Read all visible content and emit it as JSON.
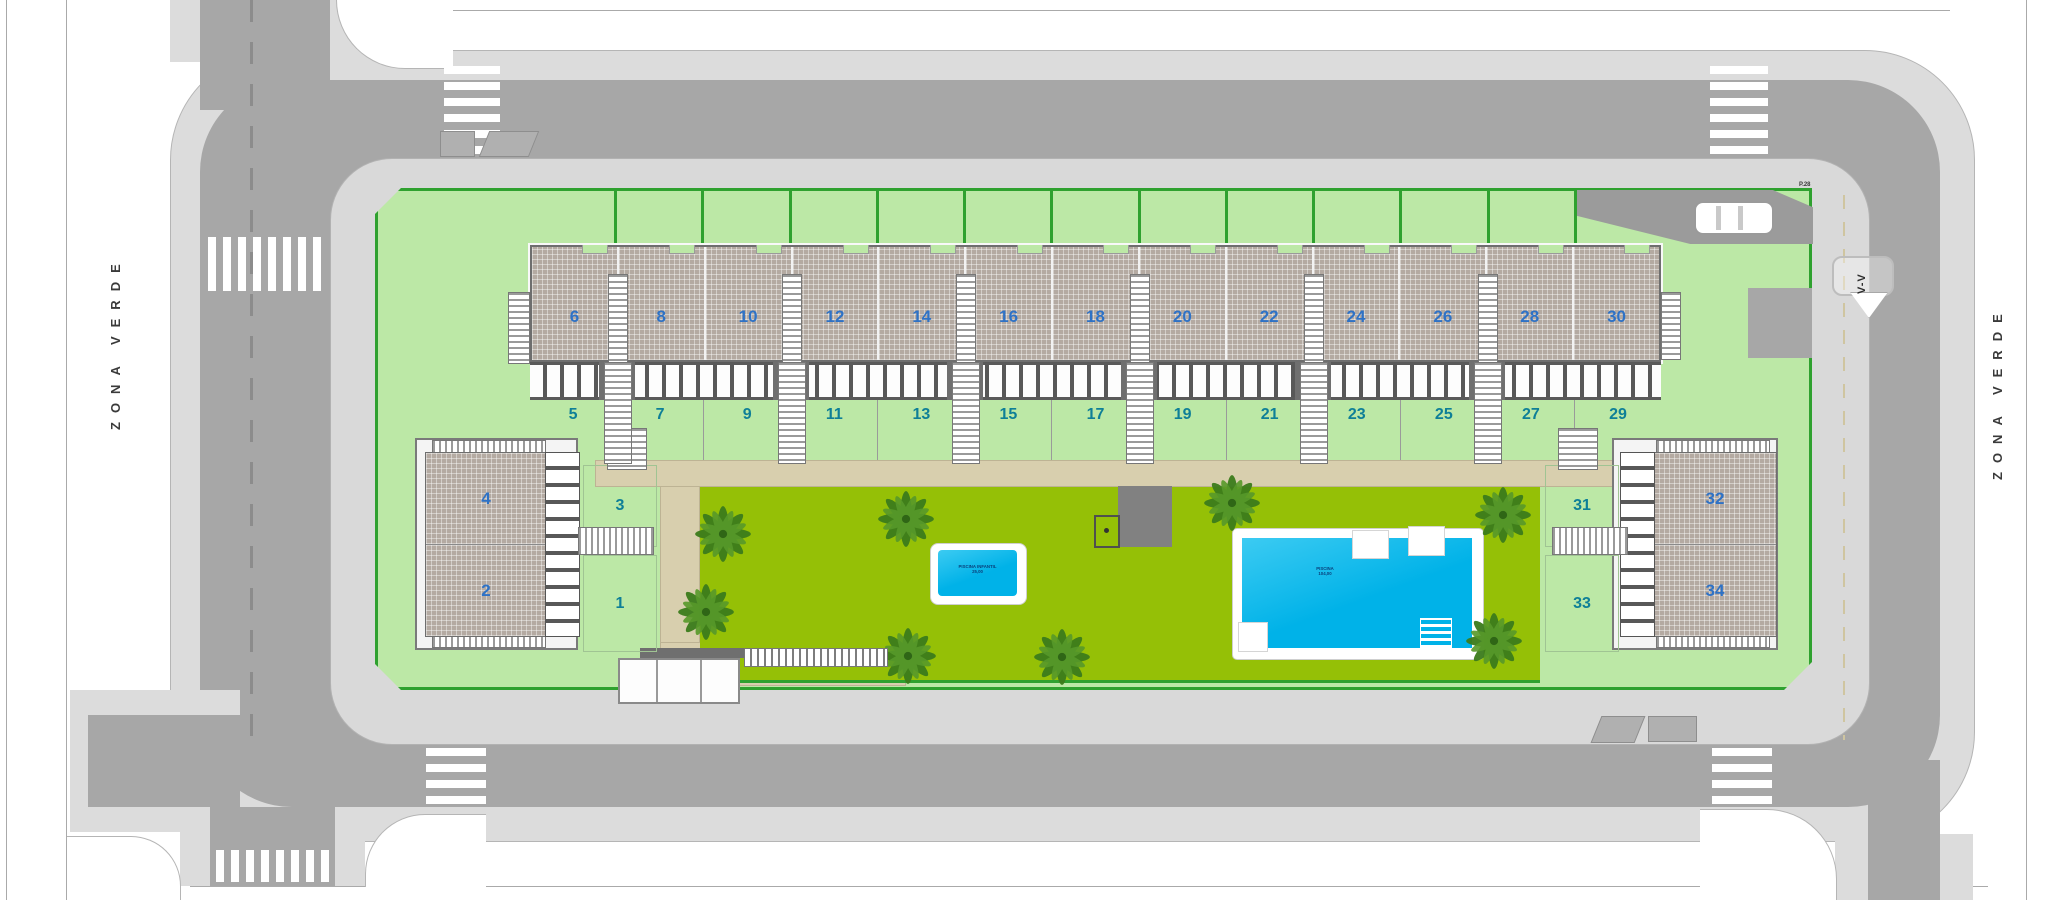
{
  "street_labels": {
    "left": "ZONA VERDE",
    "right": "ZONA VERDE"
  },
  "section_marker": {
    "label": "V-V"
  },
  "corner_label": "P.28",
  "units": {
    "row_top": [
      "6",
      "8",
      "10",
      "12",
      "14",
      "16",
      "18",
      "20",
      "22",
      "24",
      "26",
      "28",
      "30"
    ],
    "row_bottom": [
      "5",
      "7",
      "9",
      "11",
      "13",
      "15",
      "17",
      "19",
      "21",
      "23",
      "25",
      "27",
      "29"
    ],
    "left_block": {
      "top": "4",
      "bottom": "2",
      "plot_top": "3",
      "plot_bottom": "1"
    },
    "right_block": {
      "top": "32",
      "bottom": "34",
      "plot_top": "31",
      "plot_bottom": "33"
    }
  },
  "pools": {
    "kids": {
      "line1": "PISCINA INFANTIL",
      "line2": "25,00"
    },
    "main": {
      "line1": "PISCINA",
      "line2": "104,00"
    }
  },
  "colors": {
    "road": "#a7a7a7",
    "sidewalk": "#d9d9d9",
    "sidewalk_outer": "#dcdcdc",
    "parcel": "#bce8a6",
    "parcel_border": "#2fa12f",
    "lawn": "#95c006",
    "path": "#d8cfae",
    "roof": "#b4aaa2",
    "pool": "#00b2e8",
    "pool_light": "#3ccbf2",
    "number_even": "#2e72c6",
    "number_odd": "#0e7f97",
    "tree": "#3c7c1c"
  }
}
